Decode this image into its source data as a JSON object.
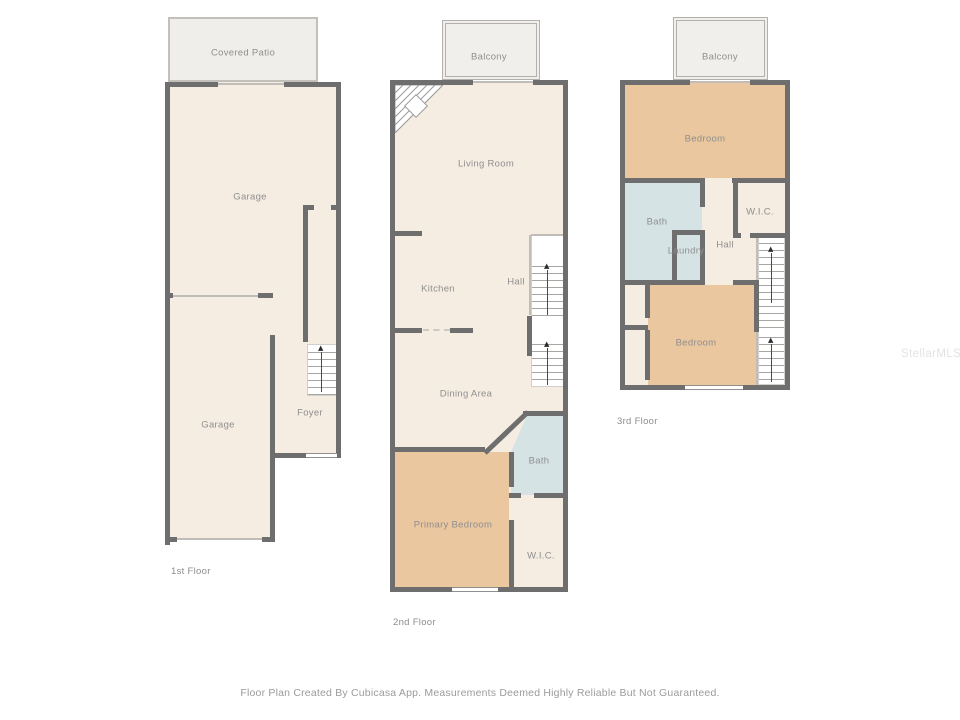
{
  "canvas": {
    "width": 960,
    "height": 720,
    "background": "#ffffff"
  },
  "colors": {
    "wall": "#6e6e6e",
    "floor_cream": "#f5ece2",
    "bedroom_tan": "#eac79f",
    "bath_blue": "#d6e3e4",
    "outdoor_gray": "#f0eeea",
    "label_gray": "#8f8f8f"
  },
  "icons": {
    "up_arrow": "▲"
  },
  "floors": [
    {
      "label": "1st Floor",
      "rooms": [
        {
          "label": "Covered Patio",
          "fill": "#f0eeea"
        },
        {
          "label": "Garage",
          "fill": "#f5ece2"
        },
        {
          "label": "Garage",
          "fill": "#f5ece2"
        },
        {
          "label": "Foyer",
          "fill": "#f5ece2"
        }
      ]
    },
    {
      "label": "2nd Floor",
      "rooms": [
        {
          "label": "Balcony",
          "fill": "#f1efec"
        },
        {
          "label": "Living Room",
          "fill": "#f5ece2"
        },
        {
          "label": "Kitchen",
          "fill": "#f5ece2"
        },
        {
          "label": "Hall",
          "fill": "#f5ece2"
        },
        {
          "label": "Dining Area",
          "fill": "#f5ece2"
        },
        {
          "label": "Primary Bedroom",
          "fill": "#eac79f"
        },
        {
          "label": "Bath",
          "fill": "#d6e3e4"
        },
        {
          "label": "W.I.C.",
          "fill": "#f5ece2"
        }
      ]
    },
    {
      "label": "3rd Floor",
      "rooms": [
        {
          "label": "Balcony",
          "fill": "#f1efec"
        },
        {
          "label": "Bedroom",
          "fill": "#eac79f"
        },
        {
          "label": "Bath",
          "fill": "#d6e3e4"
        },
        {
          "label": "Laundry",
          "fill": "#d6e3e4"
        },
        {
          "label": "W.I.C.",
          "fill": "#f5ece2"
        },
        {
          "label": "Hall",
          "fill": "#f5ece2"
        },
        {
          "label": "Bedroom",
          "fill": "#eac79f"
        }
      ]
    }
  ],
  "footer": {
    "disclaimer": "Floor Plan Created By Cubicasa App. Measurements Deemed Highly Reliable But Not Guaranteed."
  },
  "watermark": {
    "text": "StellarMLS"
  }
}
